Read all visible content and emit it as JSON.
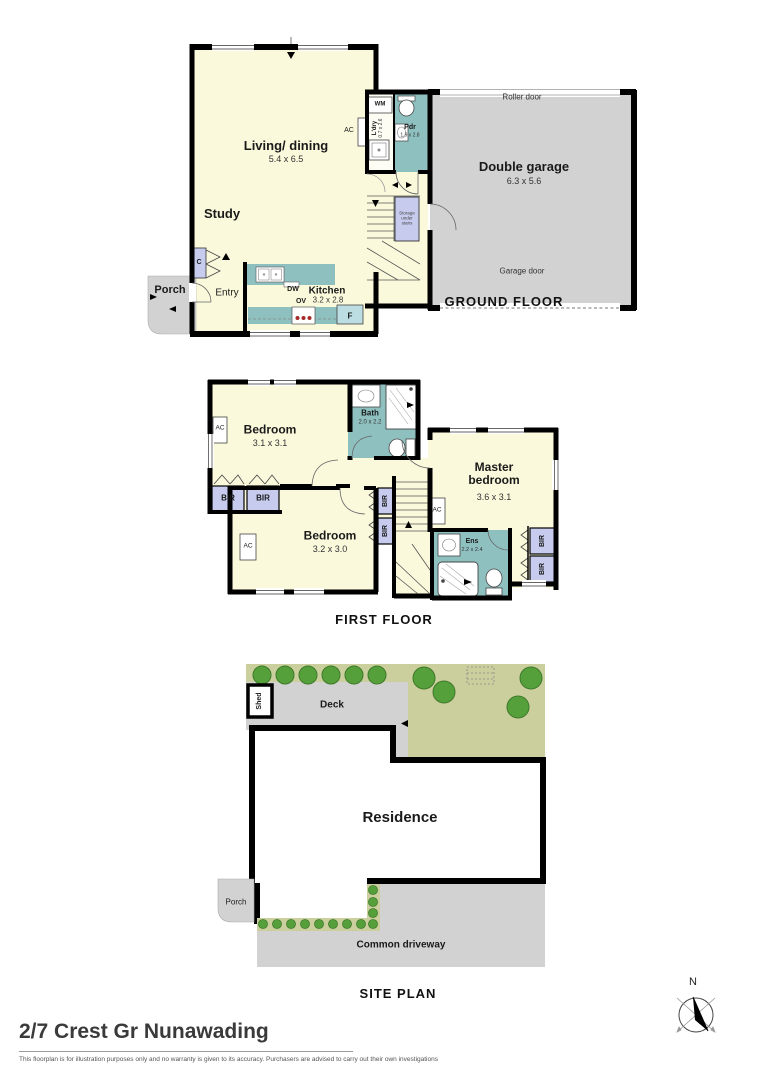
{
  "page": {
    "title": "2/7 Crest Gr Nunawading",
    "disclaimer": "This floorplan is for illustration purposes only and no warranty is given to its accuracy. Purchasers are advised to carry out their own investigations"
  },
  "shared": {
    "ac": "AC",
    "bir": "BIR"
  },
  "ground_floor": {
    "caption": "GROUND FLOOR",
    "living": {
      "name": "Living/ dining",
      "dims": "5.4 x 6.5"
    },
    "study": {
      "name": "Study"
    },
    "kitchen": {
      "name": "Kitchen",
      "dims": "3.2 x 2.8"
    },
    "laundry": {
      "name": "L'dry",
      "dims": "0.7 x 2.6"
    },
    "powder": {
      "name": "Pdr",
      "dims": "1.9 x 2.8"
    },
    "garage": {
      "name": "Double garage",
      "dims": "6.3 x 5.6"
    },
    "entry": "Entry",
    "porch": "Porch",
    "cupboard": "C",
    "wm": "WM",
    "dw": "DW",
    "ov": "OV",
    "fridge": "F",
    "roller_door": "Roller door",
    "garage_door": "Garage door",
    "storage": "Storage under stairs"
  },
  "first_floor": {
    "caption": "FIRST FLOOR",
    "bedroom1": {
      "name": "Bedroom",
      "dims": "3.1 x 3.1"
    },
    "bedroom2": {
      "name": "Bedroom",
      "dims": "3.2 x 3.0"
    },
    "master": {
      "name": "Master bedroom",
      "dims": "3.6 x 3.1"
    },
    "bath": {
      "name": "Bath",
      "dims": "2.0 x 2.2"
    },
    "ens": {
      "name": "Ens",
      "dims": "2.2 x 2.4"
    }
  },
  "site_plan": {
    "caption": "SITE PLAN",
    "residence": "Residence",
    "deck": "Deck",
    "shed": "Shed",
    "porch": "Porch",
    "driveway": "Common driveway"
  },
  "compass": {
    "north": "N"
  },
  "colors": {
    "floor": "#FBF9DC",
    "wet_area": "#8FC0C0",
    "robe": "#C7CCEF",
    "paved": "#D2D2D2",
    "garden": "#CBCE9D",
    "tree": "#55A03A",
    "wall": "#000000"
  }
}
